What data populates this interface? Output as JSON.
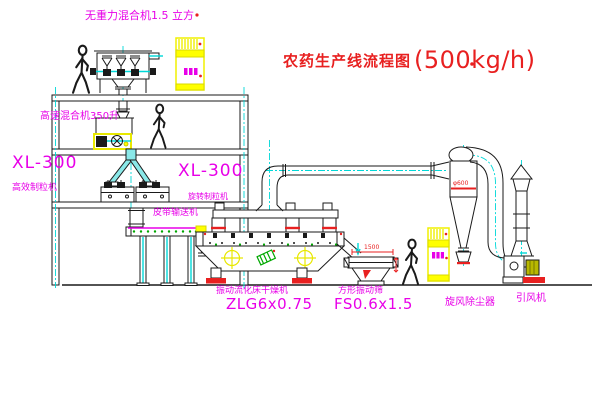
{
  "title": {
    "text_cn": "农药生产线流程图",
    "capacity": "(500kg/h)"
  },
  "labels": {
    "gravity_mixer": "无重力混合机1.5 立方",
    "high_speed_mixer": "高速混合机350升",
    "left_granulator_model": "XL-300",
    "left_granulator_name": "高效制粒机",
    "right_granulator_model": "XL-300",
    "right_granulator_name": "旋转制粒机",
    "belt_conveyor": "皮带输送机",
    "fluid_bed_dryer_name": "振动流化床干燥机",
    "fluid_bed_dryer_model": "ZLG6x0.75",
    "square_sieve_name": "方形振动筛",
    "square_sieve_model": "FS0.6x1.5",
    "cyclone_name": "旋风除尘器",
    "fan_name": "引风机"
  },
  "dimensions": {
    "sieve_length": "1500",
    "cyclone_diameter": "φ600"
  },
  "colors": {
    "label_magenta": "#e800e8",
    "title_red": "#e82020",
    "centerline_cyan": "#00d8d8",
    "cabinet_yellow": "#f5f500",
    "accent_green": "#00a800",
    "line_black": "#1a1a1a",
    "background": "#ffffff"
  }
}
